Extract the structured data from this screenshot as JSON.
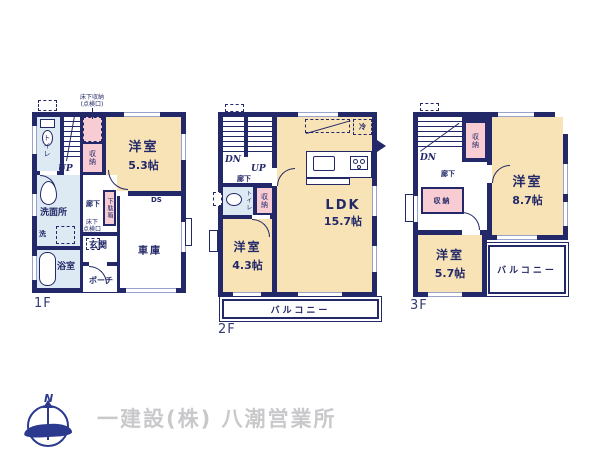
{
  "colors": {
    "wall": "#232968",
    "room_tatami": "#f8e3b6",
    "storage_pink": "#f7ccd3",
    "wet_area_blue": "#dde9f3",
    "company_gray": "#c9c9cc"
  },
  "floors": [
    {
      "id": "1F",
      "label": "1F",
      "annotations": {
        "underfloor_storage": "床下収納",
        "underfloor_storage_sub": "(点検口)",
        "inspection_l1": "床下",
        "inspection_l2": "点検口",
        "up": "UP",
        "ds": "DS"
      },
      "rooms": {
        "toilet": "トイレ",
        "closet": "収納",
        "bedroom": "洋室",
        "bedroom_size": "5.3帖",
        "washroom": "洗面所",
        "washer": "洗",
        "hallway": "廊下",
        "shoebox": "下駄箱",
        "entrance": "玄関",
        "porch": "ポーチ",
        "bathroom": "浴室",
        "garage": "車庫"
      }
    },
    {
      "id": "2F",
      "label": "2F",
      "annotations": {
        "dn": "DN",
        "up": "UP",
        "fridge": "冷"
      },
      "rooms": {
        "hallway": "廊下",
        "toilet": "トイレ",
        "closet": "収納",
        "ldk": "LDK",
        "ldk_size": "15.7帖",
        "bedroom": "洋室",
        "bedroom_size": "4.3帖",
        "balcony": "バルコニー"
      }
    },
    {
      "id": "3F",
      "label": "3F",
      "annotations": {
        "dn": "DN"
      },
      "rooms": {
        "hallway": "廊下",
        "closet_upper": "収納",
        "closet_lower": "収納",
        "bedroom_large": "洋室",
        "bedroom_large_size": "8.7帖",
        "bedroom_small": "洋室",
        "bedroom_small_size": "5.7帖",
        "balcony": "バルコニー"
      }
    }
  ],
  "footer": {
    "north_mark": "N",
    "company": "一建設(株) 八潮営業所"
  }
}
